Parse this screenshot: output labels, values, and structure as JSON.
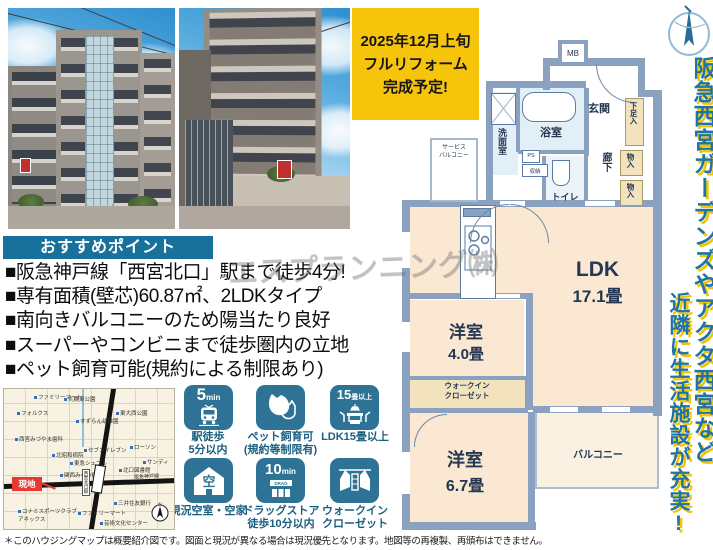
{
  "colors": {
    "accent_teal": "#17719a",
    "badge_teal": "#2e7395",
    "highlight_yellow": "#f6c50b",
    "alert_red": "#e8382f",
    "banner_blue": "#1e74a9",
    "plan_wall": "#8aa2c0",
    "plan_room": "#fae8d2"
  },
  "renovation_badge": {
    "line1": "2025年12月上旬",
    "line2": "フルリフォーム",
    "line3": "完成予定!"
  },
  "recommend": {
    "header": "おすすめポイント",
    "bullets": [
      "■阪急神戸線「西宮北口」駅まで徒歩4分!",
      "■専有面積(壁芯)60.87㎡、2LDKタイプ",
      "■南向きバルコニーのため陽当たり良好",
      "■スーパーやコンビニまで徒歩圏内の立地",
      "■ペット飼育可能(規約による制限あり)"
    ]
  },
  "watermark": "エスプランニング㈱",
  "side_banner": {
    "text1": "阪急西宮ガーデンズやアクタ西宮など",
    "text2": "近隣に生活施設が充実!"
  },
  "floor_plan": {
    "labels": {
      "mb": "MB",
      "genkan": "玄関",
      "geta": "下足入",
      "mono1": "物入",
      "mono2": "物入",
      "rouka": "廊下",
      "toilet": "トイレ",
      "bath": "浴室",
      "wash": "洗面室",
      "ps": "PS",
      "shuno": "収納",
      "service1": "サービス",
      "service2": "バルコニー",
      "ldk": "LDK",
      "ldk_size": "17.1畳",
      "room1": "洋室",
      "room1_size": "4.0畳",
      "wic1": "ウォークイン",
      "wic2": "クローゼット",
      "room2": "洋室",
      "room2_size": "6.7畳",
      "balcony": "バルコニー"
    }
  },
  "badges": [
    {
      "icon_text": "5",
      "icon_unit": "min",
      "label1": "駅徒歩",
      "label2": "5分以内"
    },
    {
      "label1": "ペット飼育可",
      "label2": "(規約等制限有)"
    },
    {
      "icon_text": "15",
      "icon_unit": "畳以上",
      "label1": "LDK15畳以上"
    },
    {
      "icon_char": "空",
      "label1": "現況空室・空家"
    },
    {
      "icon_text": "10",
      "icon_unit": "min",
      "sign": "DRAG",
      "label1": "ドラッグストア",
      "label2": "徒歩10分以内"
    },
    {
      "label1": "ウォークイン",
      "label2": "クローゼット"
    }
  ],
  "map": {
    "genchi": "現地",
    "station": "西宮北口駅",
    "rail_line": "阪急神戸線",
    "pois": [
      "ファミリーマート",
      "丸橋東公園",
      "フォルクス",
      "すずらん幼稚園",
      "西宮みづやま歯科",
      "東大西公園",
      "北昭和病院",
      "セブンイレブン",
      "東急シェブル",
      "関西みらい銀行",
      "ローソン",
      "サンディ",
      "北口図書館",
      "三井住友銀行",
      "ファミリーマート",
      "コナミスポーツクラブアネックス",
      "芸術文化センター"
    ],
    "north": "N"
  },
  "disclaimer": "＊このハウジングマップは概要紹介図です。図面と現況が異なる場合は現況優先となります。地図等の再複製、再頒布はできません。"
}
